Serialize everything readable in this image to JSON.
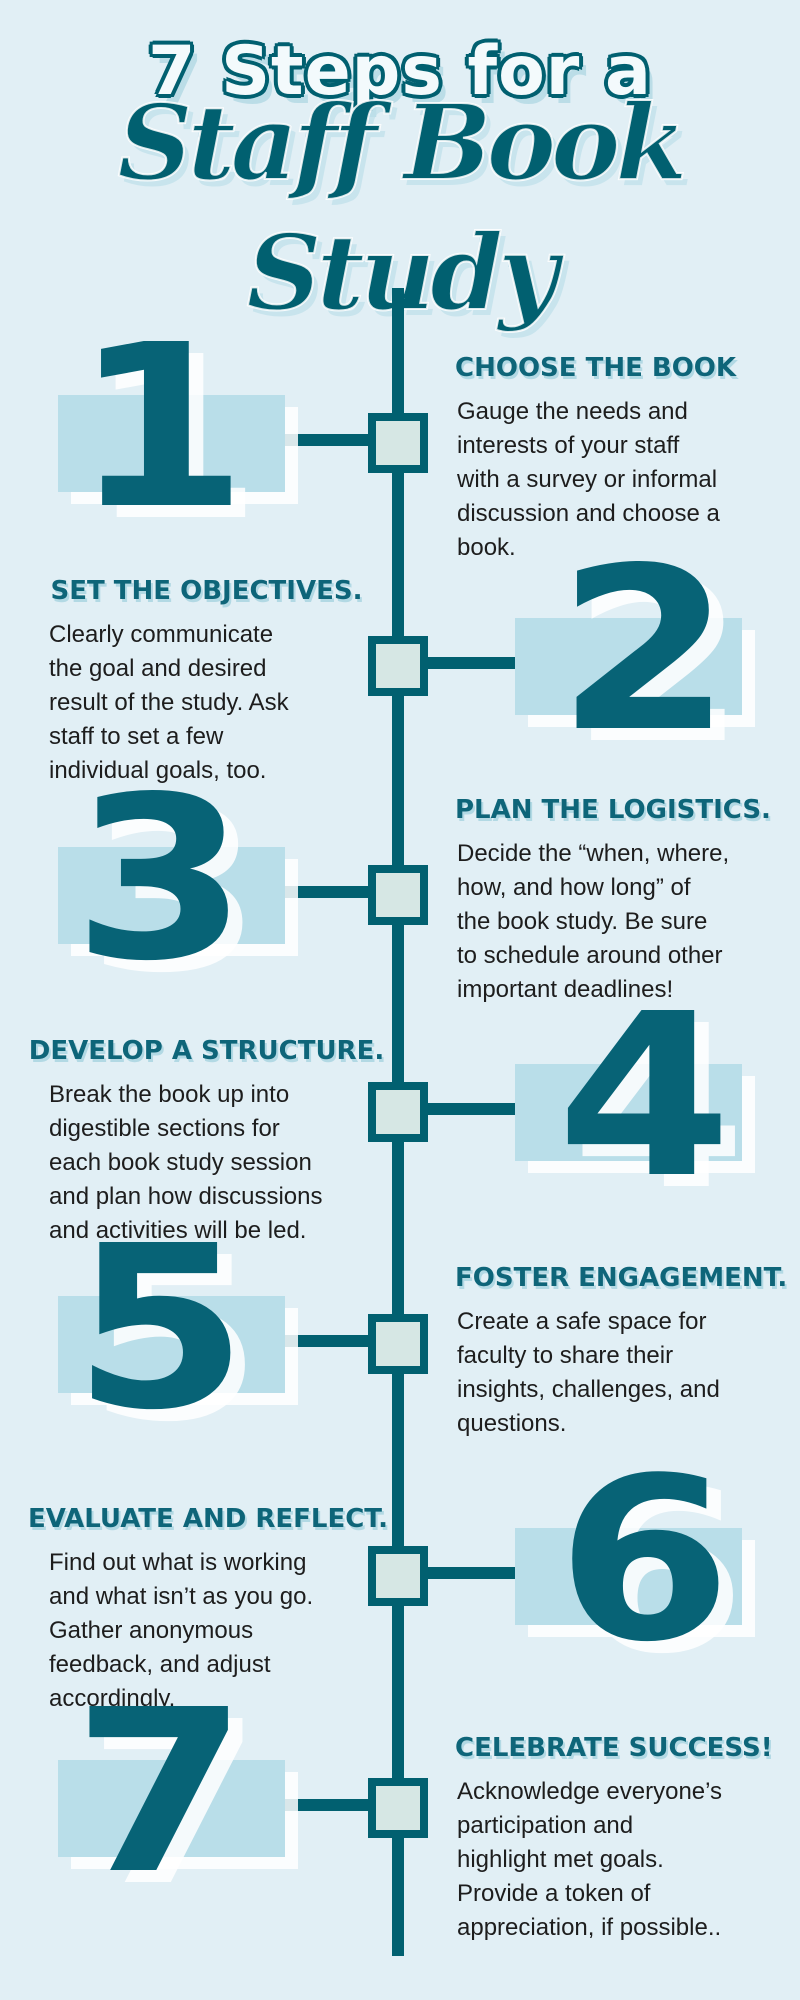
{
  "palette": {
    "bg": "#e1eff5",
    "teal": "#016070",
    "digit-teal": "#076376",
    "heading-teal": "#0e6579",
    "rect-blue": "#b9dee9",
    "node-fill": "#d6e7e4",
    "body-dark": "#1d1d1d"
  },
  "title": {
    "line1": "7 Steps for a",
    "line2": "Staff Book Study"
  },
  "steps": [
    {
      "number": "1",
      "heading": "CHOOSE THE BOOK",
      "body_lines": [
        "Gauge the needs and",
        "interests of your staff",
        "with a survey or informal",
        "discussion and choose a",
        "book."
      ]
    },
    {
      "number": "2",
      "heading": "SET THE OBJECTIVES.",
      "body_lines": [
        "Clearly communicate",
        "the goal and desired",
        "result of the study. Ask",
        "staff to set a few",
        "individual goals, too."
      ]
    },
    {
      "number": "3",
      "heading": "PLAN THE LOGISTICS.",
      "body_lines": [
        "Decide the “when, where,",
        "how, and how long” of",
        "the book study. Be sure",
        "to schedule around other",
        "important deadlines!"
      ]
    },
    {
      "number": "4",
      "heading": "DEVELOP A STRUCTURE.",
      "body_lines": [
        "Break the book up into",
        "digestible sections for",
        "each book study session",
        "and plan how discussions",
        "and activities will be led."
      ]
    },
    {
      "number": "5",
      "heading": "FOSTER ENGAGEMENT.",
      "body_lines": [
        "Create a safe space for",
        "faculty to share their",
        "insights, challenges, and",
        "questions."
      ]
    },
    {
      "number": "6",
      "heading": "EVALUATE AND REFLECT.",
      "body_lines": [
        "Find out what is working",
        "and what isn’t as you go.",
        "Gather anonymous",
        "feedback, and adjust",
        "accordingly."
      ]
    },
    {
      "number": "7",
      "heading": "CELEBRATE SUCCESS!",
      "body_lines": [
        "Acknowledge everyone’s",
        "participation and",
        "highlight met goals.",
        "Provide a token of",
        "appreciation, if possible.."
      ]
    }
  ]
}
